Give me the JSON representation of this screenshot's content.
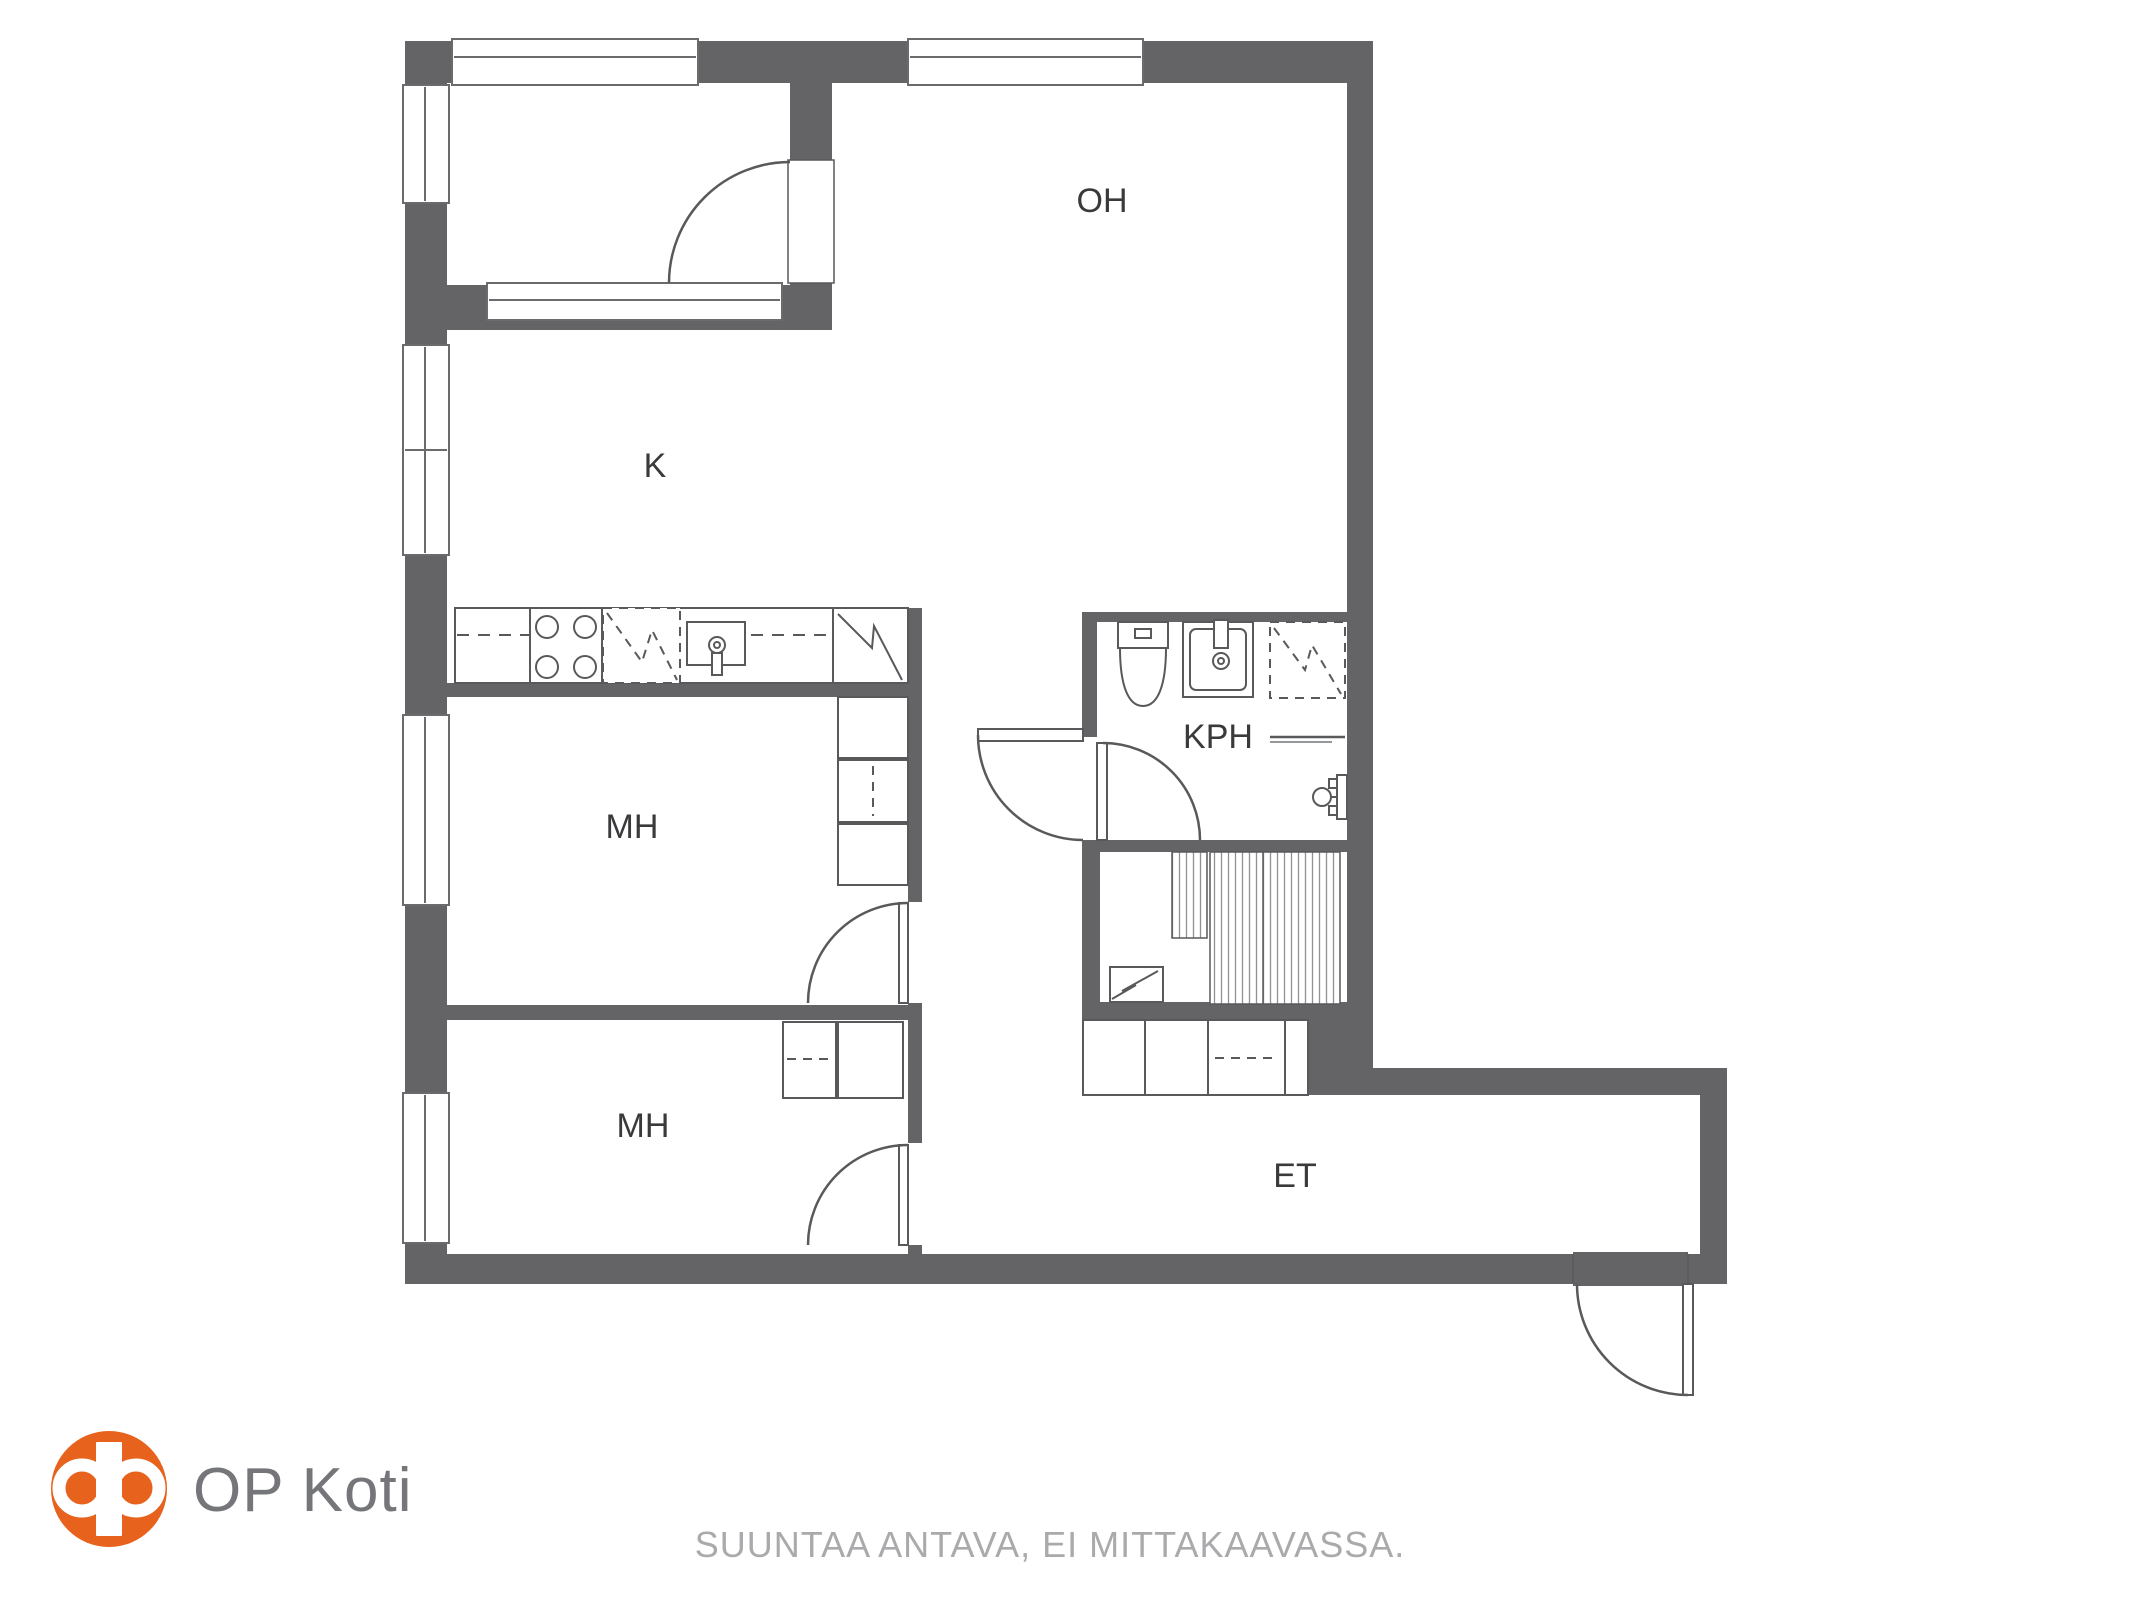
{
  "colors": {
    "wall": "#646466",
    "line": "#58595b",
    "window_stroke": "#6a6b6d",
    "hatch": "#909193",
    "label": "#3a3a3c",
    "logo_orange": "#e7631d",
    "logo_text": "#75767a",
    "note_text": "#a9aaac",
    "bg": "#ffffff"
  },
  "rooms": {
    "oh": {
      "label": "OH"
    },
    "k": {
      "label": "K"
    },
    "mh1": {
      "label": "MH"
    },
    "mh2": {
      "label": "MH"
    },
    "kph": {
      "label": "KPH"
    },
    "et": {
      "label": "ET"
    }
  },
  "fixtures": {
    "kitchen": [
      "counter",
      "stove",
      "dishwasher",
      "sink",
      "refrigerator"
    ],
    "bathroom": [
      "toilet",
      "washbasin",
      "shower",
      "towel-rail",
      "shower-mixer"
    ],
    "utility": [
      "sliding-wardrobe",
      "water-heater"
    ],
    "hallway": [
      "wardrobes"
    ],
    "door_count": 6,
    "window_count": 7
  },
  "footer": {
    "brand": "OP Koti",
    "note": "SUUNTAA ANTAVA, EI MITTAKAAVASSA."
  }
}
